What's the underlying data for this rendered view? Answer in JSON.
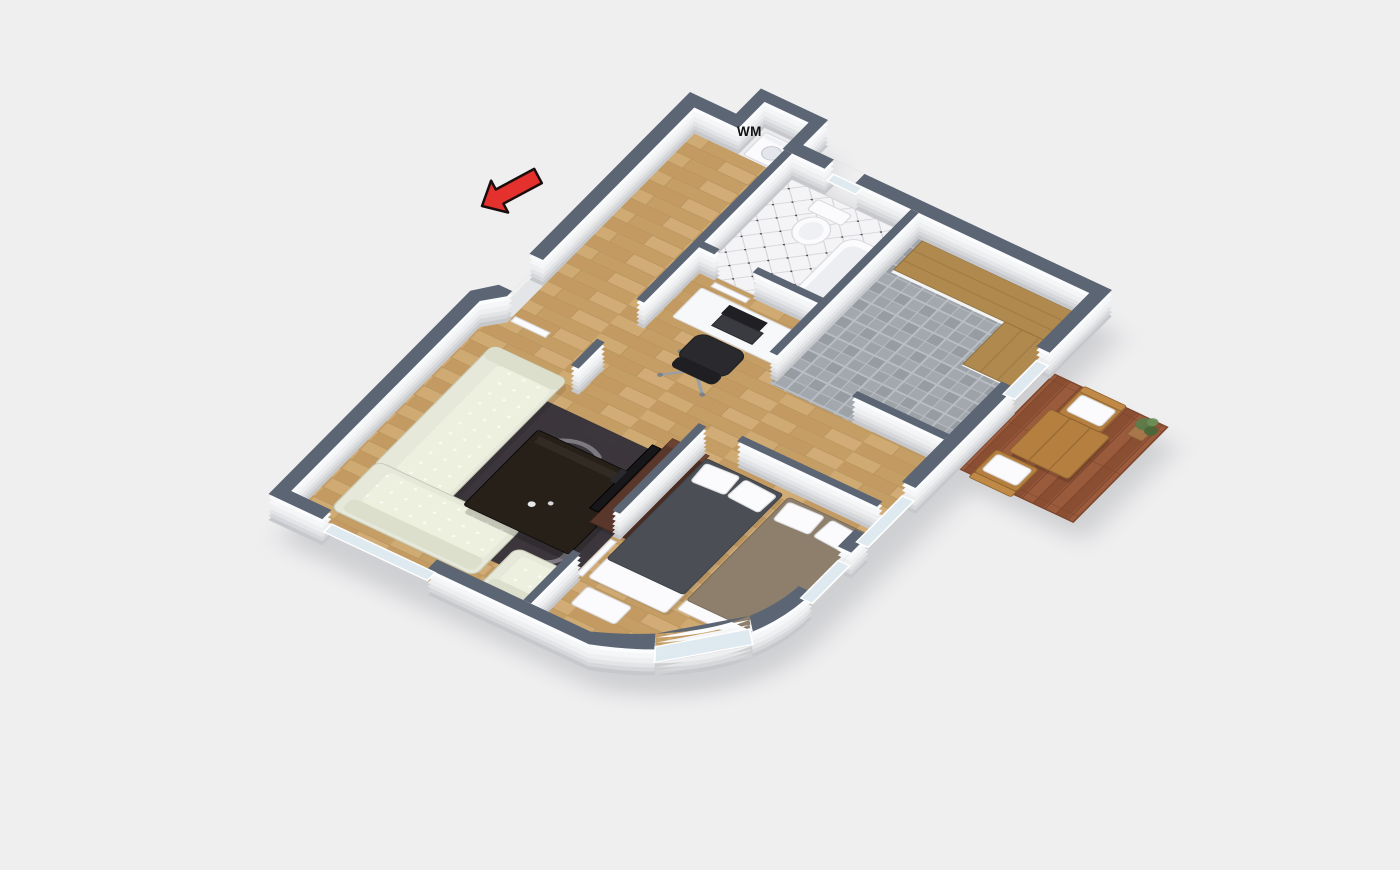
{
  "floor_plan": {
    "labels": {
      "washing_machine": "WM"
    }
  },
  "colors": {
    "background": "#efeff0",
    "wall-top": "#5b6573",
    "wall-side": "#f7f8f9",
    "wall-side-shadow": "#c6c8cc",
    "wood-floor": "#c9a36b",
    "wood-floor-dark": "#bd9359",
    "wood-floor-light": "#d7b37d",
    "wood-seam": "#a8834e",
    "kitchen-tile": "#a3a8ae",
    "kitchen-tile-dark": "#979ca2",
    "kitchen-tile-line": "#b9bec4",
    "bath-tile": "#f4f4f6",
    "bath-tile-line": "#d2d3d8",
    "bath-tile-dot": "#44464a",
    "balcony-deck": "#9a5a3c",
    "balcony-deck-dark": "#8a4e33",
    "balcony-seam": "#7c452c",
    "counter-wood": "#b0894f",
    "balcony-furniture": "#b5803f",
    "sofa-cream": "#e6e8da",
    "rug-dark": "#37333a",
    "rug-swirl": "#8e8a92",
    "coffee-table": "#262019",
    "tv-unit-brown": "#5a372b",
    "tv-black": "#17171a",
    "bed-charcoal": "#4b4f55",
    "bed-taupe": "#8d7f6b",
    "office-chair": "#2a2a2e",
    "glass": "#dfe9f0",
    "arrow-red": "#e5312d",
    "arrow-outline": "#1a0d0d",
    "label-text": "#111111",
    "shadow": "#8d8f96"
  }
}
